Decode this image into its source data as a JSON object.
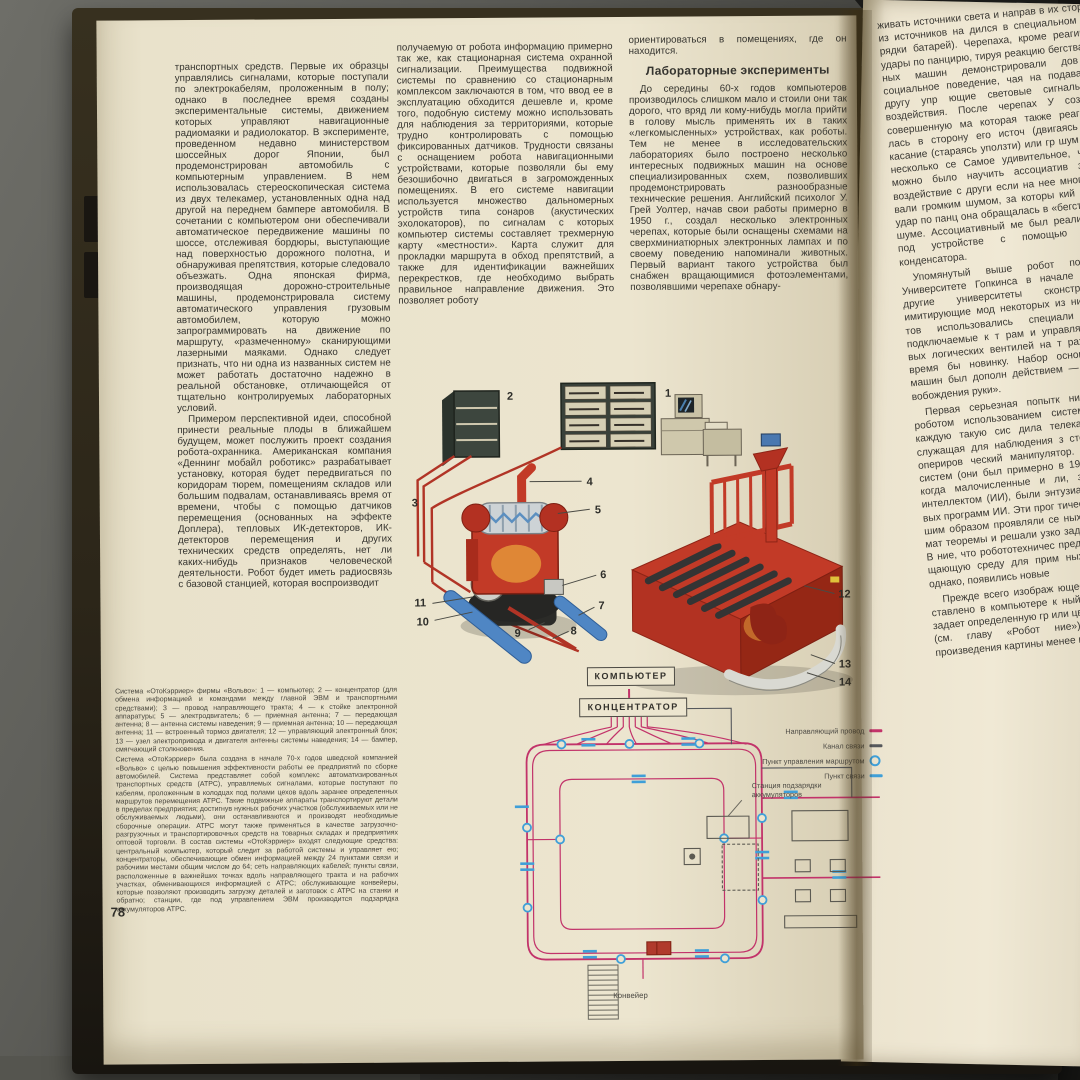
{
  "left_page": {
    "page_number": "78",
    "col1": {
      "paragraphs": [
        "транспортных средств. Первые их образцы управлялись сигналами, которые поступали по электрокабелям, проложенным в полу; однако в последнее время созданы экспериментальные системы, движением которых управляют навигационные радиомаяки и радиолокатор. В эксперименте, проведенном недавно министерством шоссейных дорог Японии, был продемонстрирован автомобиль с компьютерным управлением. В нем использовалась стереоскопическая система из двух телекамер, установленных одна над другой на переднем бампере автомобиля. В сочетании с компьютером они обеспечивали автоматическое передвижение машины по шоссе, отслеживая бордюры, выступающие над поверхностью дорожного полотна, и обнаруживая препятствия, которые следовало объезжать. Одна японская фирма, производящая дорожно-строительные машины, продемонстрировала систему автоматического управления грузовым автомобилем, которую можно запрограммировать на движение по маршруту, «размеченному» сканирующими лазерными маяками. Однако следует признать, что ни одна из названных систем не может работать достаточно надежно в реальной обстановке, отличающейся от тщательно контролируемых лабораторных условий.",
        "Примером перспективной идеи, способной принести реальные плоды в ближайшем будущем, может послужить проект создания робота-охранника. Американская компания «Деннинг мобайл роботикс» разрабатывает установку, которая будет передвигаться по коридорам тюрем, помещениям складов или большим подвалам, останавливаясь время от времени, чтобы с помощью датчиков перемещения (основанных на эффекте Доплера), тепловых ИК-детекторов, ИК-детекторов перемещения и других технических средств определять, нет ли каких-нибудь признаков человеческой деятельности. Робот будет иметь радиосвязь с базовой станцией, которая воспроизводит"
      ]
    },
    "col2": {
      "paragraphs": [
        "получаемую от робота информацию примерно так же, как стационарная система охранной сигнализации. Преимущества подвижной системы по сравнению со стационарным комплексом заключаются в том, что ввод ее в эксплуатацию обходится дешевле и, кроме того, подобную систему можно использовать для наблюдения за территориями, которые трудно контролировать с помощью фиксированных датчиков. Трудности связаны с оснащением робота навигационными устройствами, которые позволяли бы ему безошибочно двигаться в загроможденных помещениях. В его системе навигации используется множество дальномерных устройств типа сонаров (акустических эхолокаторов), по сигналам с которых компьютер системы составляет трехмерную карту «местности». Карта служит для прокладки маршрута в обход препятствий, а также для идентификации важнейших перекрестков, где необходимо выбрать правильное направление движения. Это позволяет роботу"
      ]
    },
    "col3": {
      "intro": "ориентироваться в помещениях, где он находится.",
      "heading": "Лабораторные эксперименты",
      "paragraphs": [
        "До середины 60-х годов компьютеров производилось слишком мало и стоили они так дорого, что вряд ли кому-нибудь могла прийти в голову мысль применять их в таких «легкомысленных» устройствах, как роботы. Тем не менее в исследовательских лабораториях было построено несколько интересных подвижных машин на основе специализированных схем, позволивших продемонстрировать разнообразные технические решения. Английский психолог У. Грей Уолтер, начав свои работы примерно в 1950 г., создал несколько электронных черепах, которые были оснащены схемами на сверхминиатюрных электронных лампах и по своему поведению напоминали животных. Первый вариант такого устройства был снабжен вращающимися фотоэлементами, позволявшими черепахе обнару-"
      ]
    },
    "caption": {
      "paragraphs": [
        "Система «ОтоКэрриер» фирмы «Вольво»: 1 — компьютер; 2 — концентратор (для обмена информацией и командами между главной ЭВМ и транспортными средствами); 3 — провод направляющего тракта; 4 — к стойке электронной аппаратуры; 5 — электродвигатель; 6 — приемная антенна; 7 — передающая антенна; 8 — антенна системы наведения; 9 — приемная антенна; 10 — передающая антенна; 11 — встроенный тормоз двигателя; 12 — управляющий электронный блок; 13 — узел электропривода и двигателя антенны системы наведения; 14 — бампер, смягчающий столкновения.",
        "Система «ОтоКэрриер» была создана в начале 70-х годов шведской компанией «Вольво» с целью повышения эффективности работы ее предприятий по сборке автомобилей. Система представляет собой комплекс автоматизированных транспортных средств (АТРС), управляемых сигналами, которые поступают по кабелям, проложенным в колодцах под полами цехов вдоль заранее определенных маршрутов перемещения АТРС. Такие подвижные аппараты транспортируют детали в пределах предприятия; достигнув нужных рабочих участков (обслуживаемых или не обслуживаемых людьми), они останавливаются и производят необходимые сборочные операции. АТРС могут также применяться в качестве загрузочно-разгрузочных и транспортировочных средств на товарных складах и предприятиях оптовой торговли. В состав системы «ОтоКэрриер» входят следующие средства: центральный компьютер, который следит за работой системы и управляет ею; концентраторы, обеспечивающие обмен информацией между 24 пунктами связи и рабочими местами общим числом до 64; сеть направляющих кабелей; пункты связи, расположенные в важнейших точках вдоль направляющего тракта и на рабочих участках, обменивающихся информацией с АТРС; обслуживающие конвейеры, которые позволяют производить загрузку деталей и заготовок с АТРС на станки и обратно; станции, где под управлением ЭВМ производится подзарядка аккумуляторов АТРС."
      ]
    }
  },
  "illustration": {
    "callouts": [
      "1",
      "2",
      "3",
      "4",
      "5",
      "6",
      "7",
      "8",
      "9",
      "10",
      "11",
      "12",
      "13",
      "14"
    ]
  },
  "diagram": {
    "computer_label": "КОМПЬЮТЕР",
    "concentrator_label": "КОНЦЕНТРАТОР",
    "conveyor_label": "Конвейер",
    "charging_station_label": "Станция подзарядки аккумуляторов",
    "legend": [
      {
        "label": "Направляющий провод",
        "symbol": "magenta-dash",
        "color": "#c2336a"
      },
      {
        "label": "Канал связи",
        "symbol": "dark-dash",
        "color": "#55585c"
      },
      {
        "label": "Пункт управления маршрутом",
        "symbol": "blue-ring",
        "color": "#3f9fd8"
      },
      {
        "label": "Пункт связи",
        "symbol": "blue-dash",
        "color": "#3f9fd8"
      }
    ]
  },
  "right_page": {
    "paragraphs": [
      "живать источники света и направ в их сторону (один из источников на дился в специальном отсеке по рядки батарей). Черепаха, кроме реагировала на удары по панцирю, тируя реакцию бегства. Группы п ных машин демонстрировали дов сложное социальное поведение, чая на подаваемые друг другу упр ющие световые сигналы и такти воздействия. После черепах У создал более совершенную ма которая также реагировала на лась в сторону его источ (двигаясь в сторону) касание (стараясь уползти) или гр шум (замирая на несколько се Самое удивительное, что такую м можно было научить ассоциатив зывать одно воздействие с други если на нее многократно возд вали громким шумом, за которы кий раз следовал удар по панц она обращалась в «бегство» при лишь шуме. Ассоциативный ме был реализован в этом под устройстве с помощью перез мого конденсатора.",
      "Упомянутый выше робот построенный в Университете Гопкинса в начале 60-х годов, п другие университеты сконстру подобные имитирующие мод некоторых из них вместо фото тов использовались специали ные схемы, подключаемые к т рам и управляемые системам вых логических вентилей на т рах, которые в то время бы новинку. Набор основных некоторых машин был дополн действием — «встряхиванием вобождения руки».",
      "Первая серьезная попытк нить компьютер с роботом использованием систем тип рука». В каждую такую сис дила телекамера, соединенн служащая для наблюдения з столом, на котором опериров ческий манипулятор. Самые подобных систем (они был примерно в 1965 г.) появили мя, когда малочисленные и ли, занимавшиеся иск интеллектом (ИИ), были энтузиазма, порожденного вых программ ИИ. Эти прог тически с первой же поп шим образом проявляли се ных играх, доказывали мат теоремы и решали узко задачи почти как люди. В ние, что робототехничес представляют собой бол щающую среду для прим ных «мыслящих» прог однако, появились новые",
      "Прежде всего изображ ющее от телекамеры, мо ставлено в компьютере к ный массив чисел, кажд задает определенную гр или цвет той или иной т ния (см. главу «Робот ние»). Для высококаче произведения картины менее миллиона таких"
    ]
  },
  "colors": {
    "guide_wire": "#c2336a",
    "comms_channel": "#55585c",
    "route_point": "#3f9fd8",
    "comms_point": "#3f9fd8",
    "machine_red": "#c23a27",
    "rail_blue": "#4f86c4",
    "page": "#ece5cf"
  }
}
